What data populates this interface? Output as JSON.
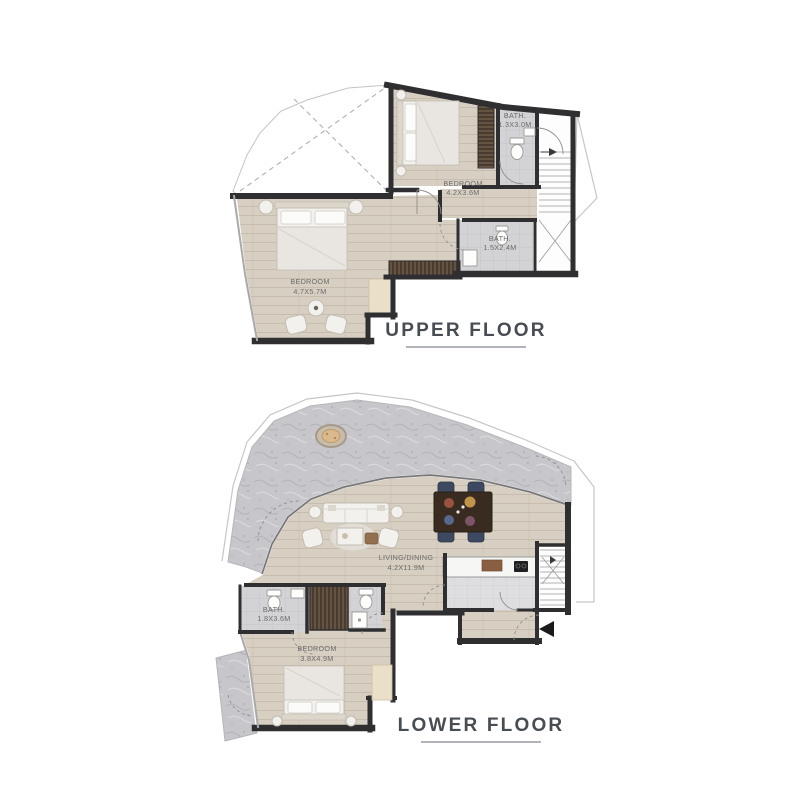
{
  "page": {
    "background": "#ffffff"
  },
  "colors": {
    "wall": "#2f2f31",
    "wood": "#d7cfc2",
    "wood_line": "#c7bcad",
    "tile": "#d3d3d6",
    "tile_light": "#dedee1",
    "stone": "#c7c7cb",
    "label": "#6b6b6b",
    "title": "#484d54",
    "underline": "#979ca3",
    "wardrobe": "#4a3b30",
    "wardrobe_slat": "#816c55",
    "arrow": "#1a1a1a",
    "furniture_fill": "#f2f1ee",
    "furniture_stroke": "#c2bcb2"
  },
  "upper_floor": {
    "title": "UPPER FLOOR",
    "rooms": {
      "bedroom_master": {
        "name": "BEDROOM",
        "dims": "4.7X5.7M"
      },
      "bedroom": {
        "name": "BEDROOM",
        "dims": "4.2X3.6M"
      },
      "bath_1": {
        "name": "BATH.",
        "dims": "1.3X3.0M"
      },
      "bath_2": {
        "name": "BATH.",
        "dims": "1.5X2.4M"
      }
    }
  },
  "lower_floor": {
    "title": "LOWER FLOOR",
    "rooms": {
      "living_dining": {
        "name": "LIVING/DINING",
        "dims": "4.2X11.9M"
      },
      "bath": {
        "name": "BATH.",
        "dims": "1.8X3.6M"
      },
      "bedroom": {
        "name": "BEDROOM",
        "dims": "3.8X4.9M"
      }
    }
  }
}
